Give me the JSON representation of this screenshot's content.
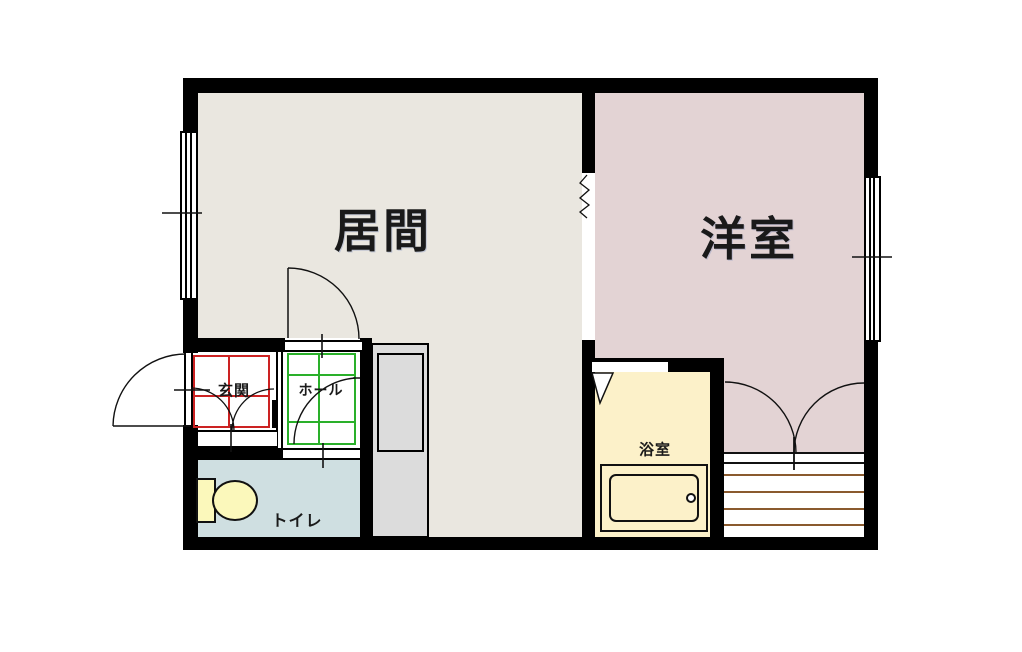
{
  "plan": {
    "type": "apartment-floor-plan",
    "rooms": [
      {
        "name": "living",
        "label": "居間"
      },
      {
        "name": "western",
        "label": "洋室"
      },
      {
        "name": "entrance",
        "label": "玄関"
      },
      {
        "name": "hall",
        "label": "ホール"
      },
      {
        "name": "toilet",
        "label": "トイレ"
      },
      {
        "name": "bath",
        "label": "浴室"
      }
    ],
    "symbols": [
      "door-swing-arc",
      "double-door-swing-arc",
      "window",
      "opening-zigzag",
      "bathtub",
      "toilet-fixture",
      "closet-shelf-lines",
      "entrance-step",
      "counter-unit"
    ],
    "colors": {
      "wall": "#000000",
      "living_floor": "#eae7e0",
      "western_floor": "#e3d3d4",
      "toilet_floor": "#cfdfe1",
      "bath_floor": "#fcf1c9",
      "fixture_yellow": "#fbf8bb",
      "unit_gray": "#dcdcdc",
      "genkan_grid": "#cc2222",
      "hall_grid": "#2ab02a",
      "shelf_line": "#8a5a2e",
      "white_floor": "#ffffff",
      "line": "#111111"
    }
  }
}
